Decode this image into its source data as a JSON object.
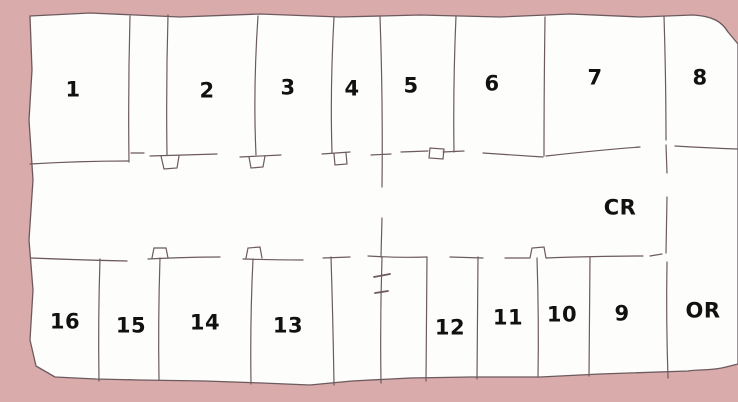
{
  "figure": {
    "kind": "hand-drawn floor plan sketch",
    "rows": 2,
    "room_count": 16
  },
  "colors": {
    "background": "#d9abab",
    "paper": "#fdfdfc",
    "wall_line": "#6c5a5f",
    "label": "#111111"
  },
  "rooms": {
    "top_row": [
      "1",
      "2",
      "3",
      "4",
      "5",
      "6",
      "7",
      "8"
    ],
    "bottom_row": [
      "16",
      "15",
      "14",
      "13",
      "12",
      "11",
      "10",
      "9"
    ],
    "corridor_label": "CR",
    "or_label": "OR"
  }
}
